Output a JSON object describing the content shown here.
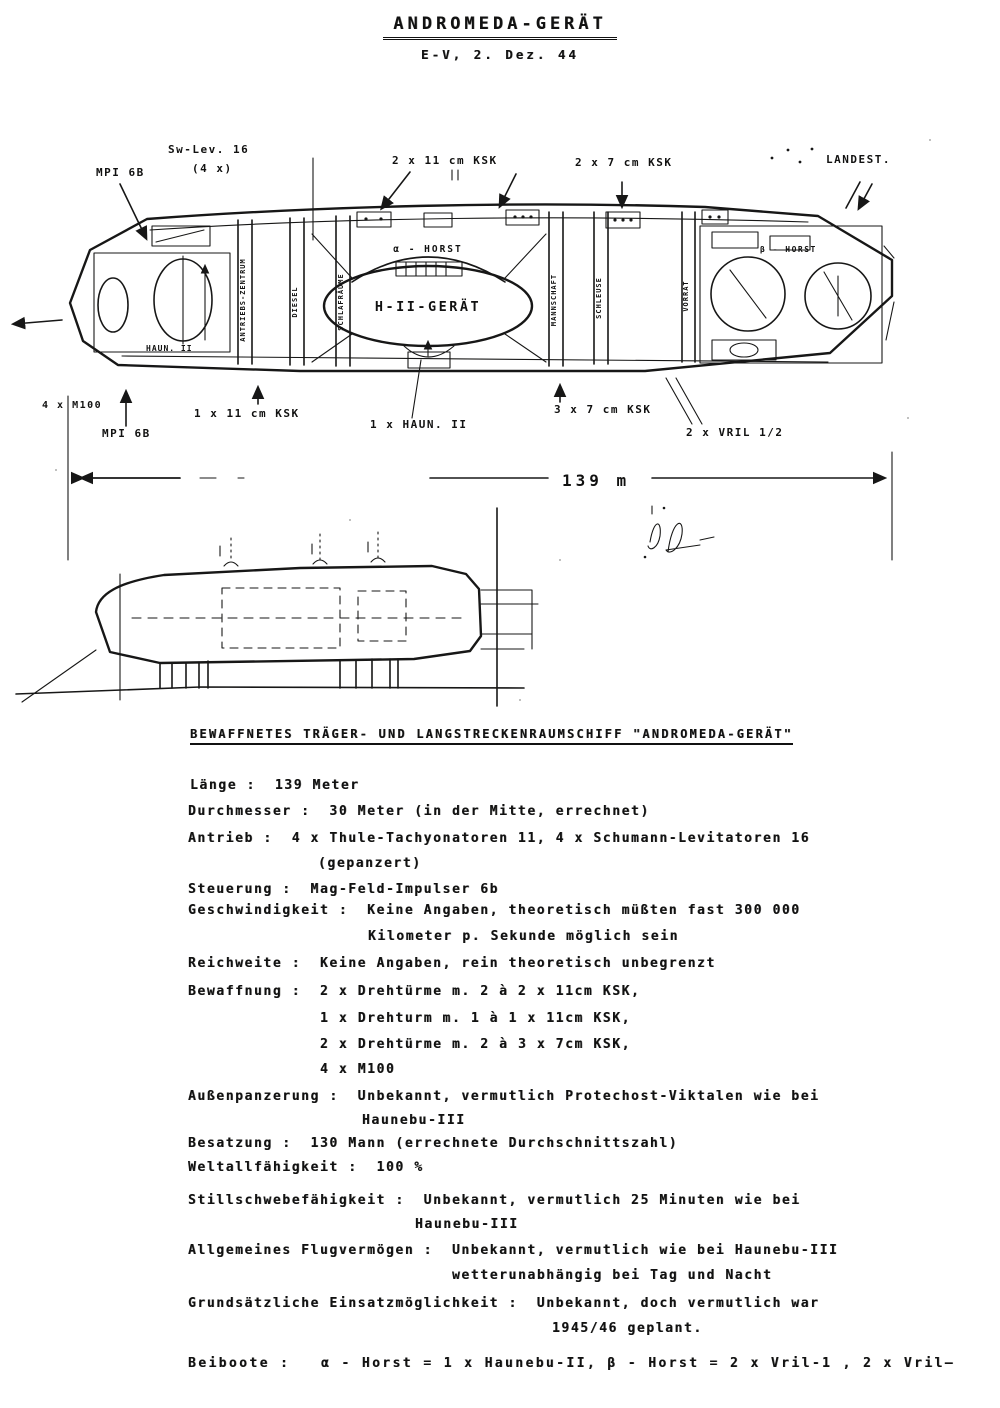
{
  "title": {
    "main": "ANDROMEDA-GERÄT",
    "sub": "E-V, 2. Dez. 44"
  },
  "diagram": {
    "dimension_label": "139 m",
    "center_dome_label": "α - HORST",
    "center_craft_label": "H-II-GERÄT",
    "right_bay_label": "β - HORST",
    "left_bay_label": "HAUN. II",
    "callouts_top": [
      "MPI 6B",
      "Sw-Lev. 16",
      "(4 x)",
      "2 x 11 cm KSK",
      "2 x 7 cm KSK",
      "LANDEST."
    ],
    "callouts_bottom": [
      "4 x M100",
      "MPI 6B",
      "1 x 11 cm KSK",
      "1 x HAUN. II",
      "3 x 7 cm KSK",
      "2 x VRIL 1/2"
    ],
    "compartment_labels": [
      "ANTRIEBS-ZENTRUM",
      "DIESEL",
      "SCHLAFRÄUME",
      "MANNSCHAFT",
      "SCHLEUSE",
      "VORRAT"
    ]
  },
  "section_heading": "BEWAFFNETES TRÄGER- UND LANGSTRECKENRAUMSCHIFF \"ANDROMEDA-GERÄT\"",
  "spec_lines": [
    "Länge :  139 Meter",
    "Durchmesser :  30 Meter (in der Mitte, errechnet)",
    "Antrieb :  4 x Thule-Tachyonatoren 11, 4 x Schumann-Levitatoren 16",
    "(gepanzert)",
    "Steuerung :  Mag-Feld-Impulser 6b",
    "Geschwindigkeit :  Keine Angaben, theoretisch müßten fast 300 000",
    "Kilometer p. Sekunde möglich sein",
    "Reichweite :  Keine Angaben, rein theoretisch unbegrenzt",
    "Bewaffnung :  2 x Drehtürme m. 2 à 2 x 11cm KSK,",
    "1 x Drehturm m. 1 à 1 x 11cm KSK,",
    "2 x Drehtürme m. 2 à 3 x 7cm KSK,",
    "4 x M100",
    "Außenpanzerung :  Unbekannt, vermutlich Protechost-Viktalen wie bei",
    "Haunebu-III",
    "Besatzung :  130 Mann (errechnete Durchschnittszahl)",
    "Weltallfähigkeit :  100 %",
    "Stillschwebefähigkeit :  Unbekannt, vermutlich 25 Minuten wie bei",
    "Haunebu-III",
    "Allgemeines Flugvermögen :  Unbekannt, vermutlich wie bei Haunebu-III",
    "wetterunabhängig bei Tag und Nacht",
    "Grundsätzliche Einsatzmöglichkeit :  Unbekannt, doch vermutlich war",
    "1945/46 geplant.",
    "Beiboote :   α - Horst = 1 x Haunebu-II, β - Horst = 2 x Vril-1 , 2 x Vril—"
  ]
}
